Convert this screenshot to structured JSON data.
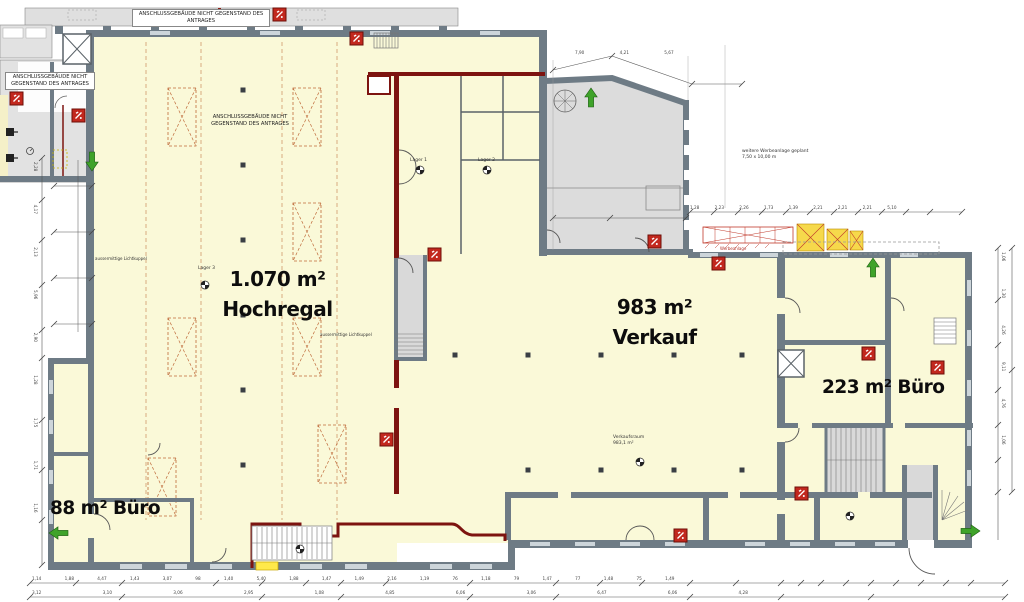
{
  "colors": {
    "cream": "#faf9d8",
    "wall_gray": "#6e7b85",
    "neighbor_gray": "#e2e2e2",
    "room_gray": "#d9d9d9",
    "firewall_red": "#7d1410",
    "marker_red": "#c2281e",
    "arrow_green": "#3fa32a",
    "rack_sienna": "#bf6a3a",
    "highlight_yellow": "#ffe94a"
  },
  "areas": {
    "hochregal_value": "1.070 m²",
    "hochregal_name": "Hochregal",
    "verkauf_value": "983 m²",
    "verkauf_name": "Verkauf",
    "buero_right": "223 m² Büro",
    "buero_left": "88 m² Büro"
  },
  "notes": {
    "anschluss_top": "ANSCHLUSSGEBÄUDE NICHT GEGENSTAND DES ANTRAGES",
    "anschluss_left": "ANSCHLUSSGEBÄUDE NICHT GEGENSTAND DES ANTRAGES",
    "anschluss_hall": "ANSCHLUSSGEBÄUDE NICHT GEGENSTAND DES ANTRAGES",
    "werbeanlage_line1": "weitere Werbeanlage geplant",
    "werbeanlage_line2": "7,50 x 10,00 m",
    "werbeanlage_red": "Werbeanlage"
  },
  "rooms": {
    "lager1": "Lager 1",
    "lager2": "Lager 2",
    "lager3": "Lager 3",
    "verkaufsraum_name": "Verkaufsraum",
    "verkaufsraum_area": "983,1 m²",
    "lichtkuppel": "aussermittige Lichtkuppel"
  },
  "dimensions": {
    "bottom_row1": "1,14 1,88 4,47 1,43 3,07 98 1,40 5,40 1,88 1,47 1,49 2,16 1,19 76 1,18 79 1,47 77 1,48 75 1,49",
    "bottom_row2": "3,12 3,10 3,06 2,95 1,08 4,85 6,06 3,06 6,47 6,06 4,28",
    "left_col": "2,28 4,17 2,13 5,96 2,90 1,28 1,75 1,71 1,16",
    "right_col": "1,06 1,30 4,26 9,11 4,76 1,06",
    "wing_top": "1,28 2,23 2,26 1,73 1,39 2,21 2,21 2,21 5,10",
    "gray_room_top": "7,90 4,21 5,67"
  }
}
